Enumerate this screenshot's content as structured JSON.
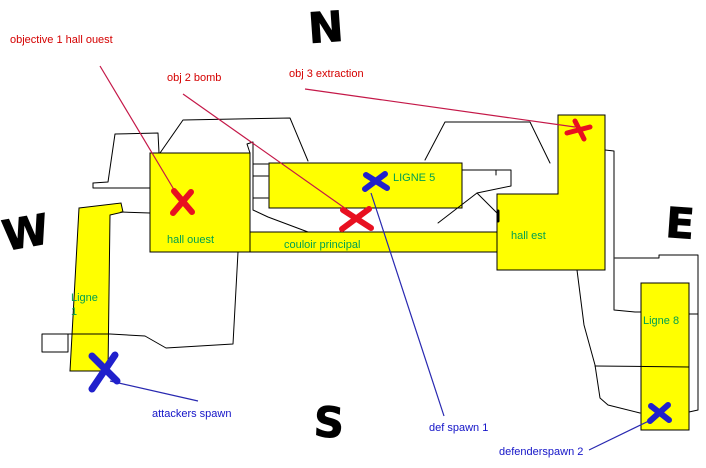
{
  "compass": {
    "north": "N",
    "south": "S",
    "east": "E",
    "west": "W"
  },
  "rooms": {
    "hall_ouest": {
      "label": "hall ouest"
    },
    "ligne5": {
      "label": "LIGNE 5"
    },
    "couloir": {
      "label": "couloir principal"
    },
    "hall_est": {
      "label": "hall est"
    },
    "ligne1": {
      "label": "Ligne",
      "line2": "1"
    },
    "ligne8": {
      "label": "Ligne 8"
    }
  },
  "objectives": {
    "obj1": {
      "label": "objective 1 hall ouest",
      "marker": "red-x"
    },
    "obj2": {
      "label": "obj 2 bomb",
      "marker": "red-x"
    },
    "obj3": {
      "label": "obj 3 extraction",
      "marker": "red-x"
    }
  },
  "spawns": {
    "attackers": {
      "label": "attackers spawn",
      "marker": "blue-x"
    },
    "def1": {
      "label": "def spawn 1",
      "marker": "blue-x"
    },
    "def2": {
      "label": "defenderspawn 2",
      "marker": "blue-x"
    }
  },
  "colors": {
    "background": "#ffffff",
    "room_fill": "#ffff00",
    "outline": "#000000",
    "room_label": "#00a050",
    "objective_text": "#d40000",
    "objective_line": "#c41848",
    "objective_marker": "#e81020",
    "spawn_text": "#1414c8",
    "spawn_line": "#2828b0",
    "spawn_marker": "#2020cc"
  }
}
